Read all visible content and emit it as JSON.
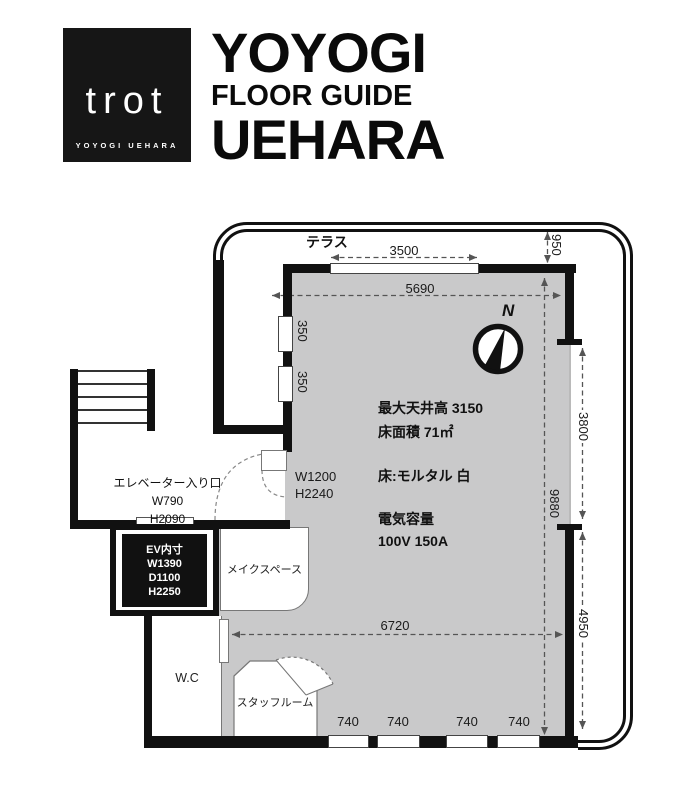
{
  "header": {
    "logo": {
      "name": "trot",
      "subtitle": "YOYOGI UEHARA"
    },
    "title": {
      "line1": "YOYOGI",
      "line2": "FLOOR GUIDE",
      "line3": "UEHARA"
    }
  },
  "plan": {
    "terrace_label": "テラス",
    "compass_label": "N",
    "dims": {
      "terrace_window_width": "3500",
      "terrace_depth": "950",
      "room_width_top": "5690",
      "left_window_1": "350",
      "left_window_2": "350",
      "room_depth": "9880",
      "right_opening_upper": "3800",
      "right_opening_lower": "4950",
      "room_width_bottom": "6720",
      "bottom_windows": [
        "740",
        "740",
        "740",
        "740"
      ]
    },
    "main_room": {
      "spec_line1": "最大天井高 3150",
      "spec_line2": "床面積 71㎡",
      "spec_line3": "床:モルタル 白",
      "spec_line4": "電気容量",
      "spec_line5": "100V 150A",
      "door_spec_line1": "W1200",
      "door_spec_line2": "H2240"
    },
    "elevator": {
      "entrance_line1": "エレベーター入り口",
      "entrance_line2": "W790",
      "entrance_line3": "H2090",
      "interior_line1": "EV内寸",
      "interior_line2": "W1390",
      "interior_line3": "D1100",
      "interior_line4": "H2250"
    },
    "rooms": {
      "makeup_space": "メイクスペース",
      "wc": "W.C",
      "staff_room": "スタッフルーム"
    }
  }
}
